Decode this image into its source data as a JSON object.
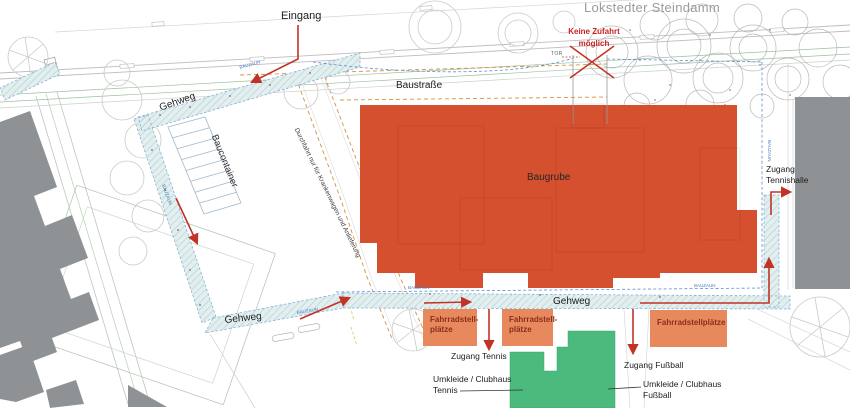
{
  "plan": {
    "street_name": "Lokstedter Steindamm",
    "entrance": "Eingang",
    "no_access": [
      "Keine Zufahrt",
      "möglich"
    ],
    "construction_road": "Baustraße",
    "walkway": "Gehweg",
    "container": "Baucontainer",
    "through_traffic": "Durchfahrt nur für Krankenwagen und Anlieferung",
    "excavation": "Baugrube",
    "gate": "TOR",
    "fence": "BAUZAUN",
    "bike_two_line": [
      "Fahrradstell-",
      "plätze"
    ],
    "bike_one_line": "Fahrradstellplätze",
    "access_tennis": "Zugang Tennis",
    "access_football": "Zugang Fußball",
    "access_tennis_hall": [
      "Zugang",
      "Tennishalle"
    ],
    "clubhouse_tennis": [
      "Umkleide / Clubhaus",
      "Tennis"
    ],
    "clubhouse_football": [
      "Umkleide / Clubhaus",
      "Fußball"
    ]
  },
  "colors": {
    "excavation_red": "#d4502f",
    "bike_box_orange": "#e8895d",
    "building_green": "#4cba7c",
    "building_gray": "#8f9294",
    "arrow_red": "#c13327",
    "fence_blue": "#5e8ed0",
    "road_orange": "#d6913f",
    "walkway_fill": "#e3efee",
    "street_label_gray": "#9b9b9b",
    "warning_red": "#cb2020"
  }
}
